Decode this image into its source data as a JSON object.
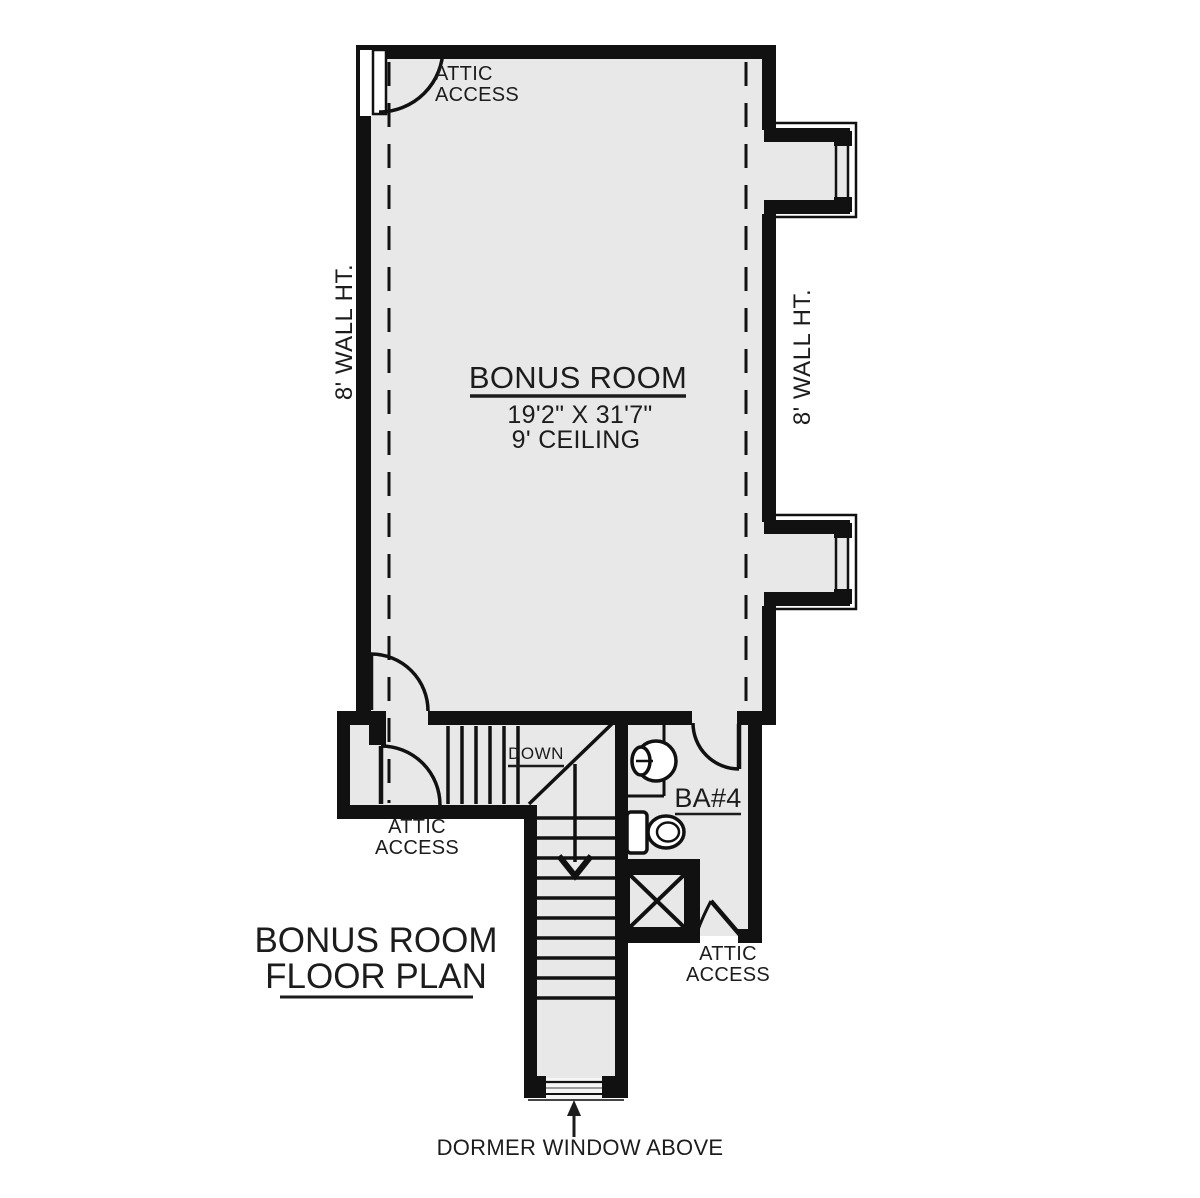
{
  "plan_heading": {
    "line1": "BONUS ROOM",
    "line2": "FLOOR PLAN"
  },
  "bonus_room": {
    "name": "BONUS ROOM",
    "dimensions": "19'2\" X 31'7\"",
    "ceiling": "9' CEILING"
  },
  "bathroom": {
    "name": "BA#4"
  },
  "stairs": {
    "down_label": "DOWN"
  },
  "wall_heights": {
    "left": "8' WALL HT.",
    "right": "8' WALL HT."
  },
  "attic_access_labels": {
    "top": {
      "line1": "ATTIC",
      "line2": "ACCESS"
    },
    "bottom_left": {
      "line1": "ATTIC",
      "line2": "ACCESS"
    },
    "bottom_right": {
      "line1": "ATTIC",
      "line2": "ACCESS"
    }
  },
  "annotations": {
    "dormer_window": "DORMER WINDOW ABOVE"
  },
  "colors": {
    "wall": "#111111",
    "floor": "#e8e8e8",
    "background": "#ffffff",
    "text": "#1c1c1c"
  }
}
